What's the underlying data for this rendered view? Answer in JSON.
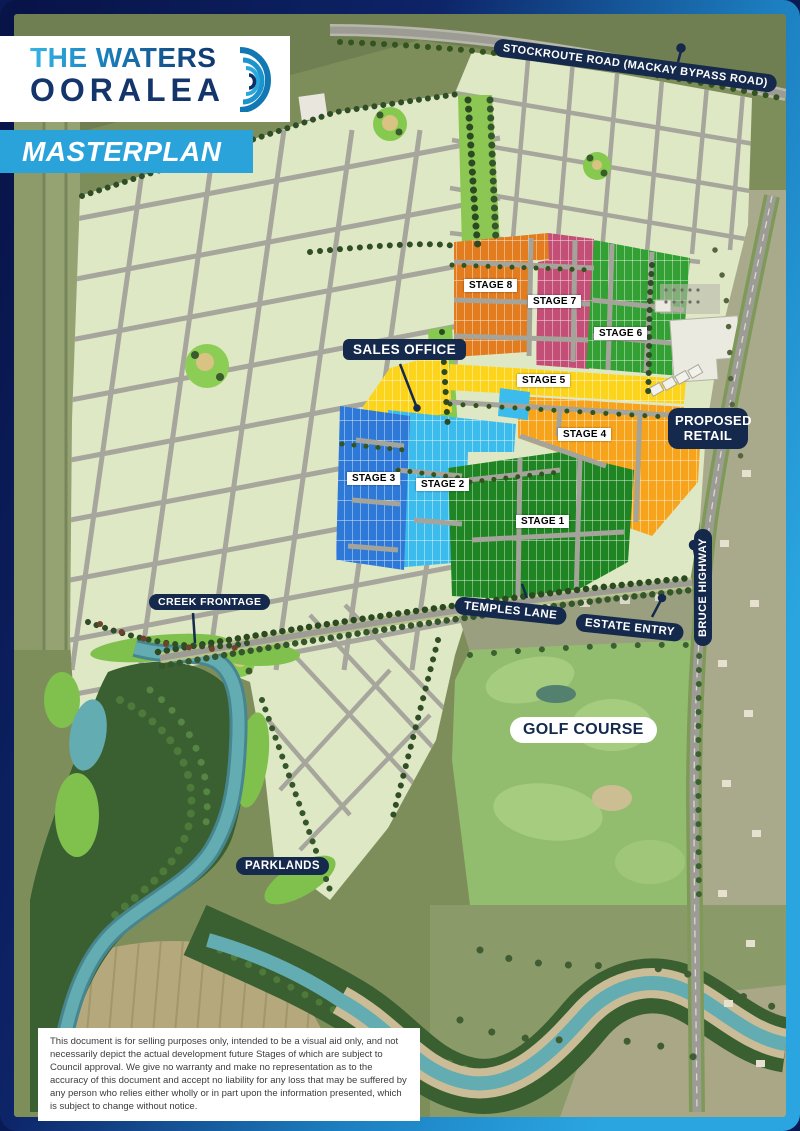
{
  "logo": {
    "line1": "THE WATERS",
    "line2": "OORALEA",
    "icon": "ripple-icon"
  },
  "banner": {
    "label": "MASTERPLAN"
  },
  "road_labels": {
    "stockroute": "STOCKROUTE ROAD (MACKAY BYPASS ROAD)",
    "temples_lane": "TEMPLES LANE",
    "estate_entry": "ESTATE ENTRY",
    "bruce_highway": "BRUCE HIGHWAY"
  },
  "place_labels": {
    "sales_office": "SALES OFFICE",
    "proposed_retail": "PROPOSED RETAIL",
    "creek_frontage": "CREEK FRONTAGE",
    "golf_course": "GOLF COURSE",
    "parklands": "PARKLANDS"
  },
  "stages": [
    {
      "label": "STAGE 1",
      "color": "#1e8522"
    },
    {
      "label": "STAGE 2",
      "color": "#3cbcec"
    },
    {
      "label": "STAGE 3",
      "color": "#2e79d8"
    },
    {
      "label": "STAGE 4",
      "color": "#f7a41c"
    },
    {
      "label": "STAGE 5",
      "color": "#fdd41c"
    },
    {
      "label": "STAGE 6",
      "color": "#33a034"
    },
    {
      "label": "STAGE 7",
      "color": "#c44f76"
    },
    {
      "label": "STAGE 8",
      "color": "#e27c1e"
    }
  ],
  "disclaimer": "This document is for selling purposes only, intended to be a visual aid only, and not necessarily depict the actual development future Stages of which are subject to Council approval.  We give no warranty and make no representation as to the accuracy of this document and accept no liability for any loss that may be suffered by any person who relies either wholly or in part upon the information presented, which is subject to change without notice.",
  "colors": {
    "pill_navy": "#14294b",
    "banner_blue": "#2aa2da",
    "logo_navy": "#14356b",
    "border_navy": "#0a1a55",
    "border_blue": "#2aa5e0",
    "estate_green": "#dfe8c5",
    "river_teal": "#63acb1"
  }
}
